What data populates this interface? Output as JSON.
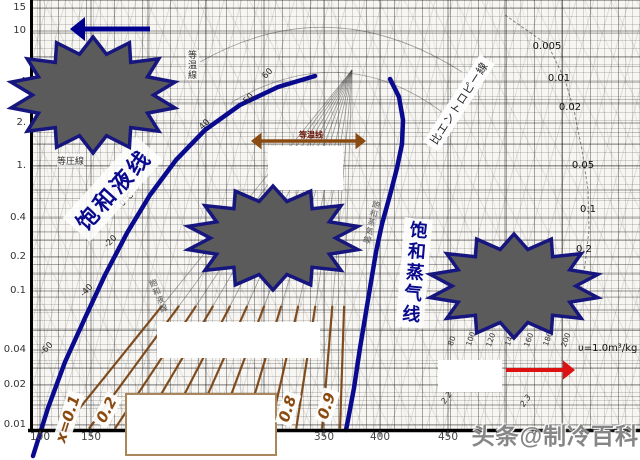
{
  "figure": {
    "width": 640,
    "height": 460
  },
  "watermark": {
    "text": "头条@制冷百科"
  },
  "annotations": {
    "sat_liquid_label": "饱和液线",
    "sat_vapor_label": "饱和蒸气线",
    "isotherm_arrow_label": "等温线",
    "isobar_print_label": "等圧線",
    "isotherm_print_label": "等温線",
    "entropy_print_label": "比エントロピー線",
    "vapor_print_label": "飽和蒸気線",
    "liquid_print_label": "飽和液線",
    "volume_note": "υ=1.0m³/kg"
  },
  "chart_data": {
    "type": "line",
    "title": "",
    "x_axis": {
      "label": "",
      "ticks": [
        {
          "label": "100",
          "x": 40
        },
        {
          "label": "150",
          "x": 91
        },
        {
          "label": "350",
          "x": 324
        },
        {
          "label": "400",
          "x": 380
        },
        {
          "label": "450",
          "x": 448
        },
        {
          "label": "500",
          "x": 505
        }
      ]
    },
    "y_axis": {
      "label": "",
      "scale": "log",
      "ticks": [
        {
          "label": "15",
          "y": 8
        },
        {
          "label": "10",
          "y": 31
        },
        {
          "label": "4",
          "y": 82
        },
        {
          "label": "2.",
          "y": 123
        },
        {
          "label": "1.",
          "y": 166
        },
        {
          "label": "0.4",
          "y": 218
        },
        {
          "label": "0.2",
          "y": 257
        },
        {
          "label": "0.1",
          "y": 291
        },
        {
          "label": "0.04",
          "y": 350
        },
        {
          "label": "0.02",
          "y": 385
        },
        {
          "label": "0.01",
          "y": 425
        }
      ]
    },
    "saturation_temp_labels": [
      {
        "label": "60",
        "x": 268,
        "y": 74
      },
      {
        "label": "50",
        "x": 249,
        "y": 99
      },
      {
        "label": "40",
        "x": 205,
        "y": 125
      },
      {
        "label": "20",
        "x": 140,
        "y": 166
      },
      {
        "label": "0°C",
        "x": 127,
        "y": 200
      },
      {
        "label": "-20",
        "x": 111,
        "y": 242
      },
      {
        "label": "-40",
        "x": 87,
        "y": 291
      },
      {
        "label": "-60",
        "x": 47,
        "y": 349
      }
    ],
    "specific_volume_labels": [
      {
        "label": "0.005",
        "x": 547,
        "y": 47
      },
      {
        "label": "0.01",
        "x": 559,
        "y": 79
      },
      {
        "label": "0.02",
        "x": 570,
        "y": 108
      },
      {
        "label": "0.05",
        "x": 583,
        "y": 166
      },
      {
        "label": "0.1",
        "x": 588,
        "y": 210
      },
      {
        "label": "0.2",
        "x": 584,
        "y": 250
      }
    ],
    "superheat_temp_labels": [
      {
        "label": "80",
        "x": 452,
        "y": 341
      },
      {
        "label": "100",
        "x": 471,
        "y": 339
      },
      {
        "label": "120",
        "x": 491,
        "y": 340
      },
      {
        "label": "140",
        "x": 510,
        "y": 339
      },
      {
        "label": "160",
        "x": 529,
        "y": 340
      },
      {
        "label": "180",
        "x": 548,
        "y": 339
      },
      {
        "label": "200",
        "x": 566,
        "y": 340
      }
    ],
    "entropy_tick_labels": [
      {
        "label": "2.2",
        "x": 447,
        "y": 398
      },
      {
        "label": "2.3",
        "x": 526,
        "y": 401
      }
    ],
    "quality_labels": [
      {
        "label": "x=0.1",
        "x": 68,
        "y": 419,
        "rot": -72
      },
      {
        "label": "0.2",
        "x": 107,
        "y": 410,
        "rot": -62
      },
      {
        "label": "0.8",
        "x": 288,
        "y": 409,
        "rot": -72
      },
      {
        "label": "0.9",
        "x": 327,
        "y": 406,
        "rot": -72
      }
    ],
    "series": [
      {
        "name": "saturated-liquid-line",
        "color": "#0a0a8f",
        "width": 4.5,
        "points": [
          [
            33,
            456
          ],
          [
            48,
            408
          ],
          [
            65,
            362
          ],
          [
            85,
            318
          ],
          [
            105,
            275
          ],
          [
            127,
            233
          ],
          [
            150,
            195
          ],
          [
            176,
            160
          ],
          [
            205,
            130
          ],
          [
            240,
            105
          ],
          [
            278,
            87
          ],
          [
            315,
            76
          ]
        ]
      },
      {
        "name": "saturated-vapor-line",
        "color": "#0a0a8f",
        "width": 4.5,
        "points": [
          [
            390,
            79
          ],
          [
            399,
            97
          ],
          [
            403,
            120
          ],
          [
            402,
            144
          ],
          [
            397,
            168
          ],
          [
            390,
            195
          ],
          [
            382,
            224
          ],
          [
            376,
            252
          ],
          [
            371,
            282
          ],
          [
            366,
            312
          ],
          [
            360,
            348
          ],
          [
            354,
            388
          ],
          [
            348,
            420
          ],
          [
            346,
            430
          ]
        ]
      }
    ]
  },
  "decorations": {
    "censor_stars": [
      {
        "cx": 93,
        "cy": 95,
        "rx": 84,
        "ry": 58
      },
      {
        "cx": 273,
        "cy": 238,
        "rx": 87,
        "ry": 52
      },
      {
        "cx": 514,
        "cy": 286,
        "rx": 86,
        "ry": 52
      }
    ],
    "star_fill": "#5b5b5b",
    "star_stroke": "#16167e",
    "white_boxes": [
      {
        "x": 268,
        "y": 146,
        "w": 75,
        "h": 44,
        "border": ""
      },
      {
        "x": 157,
        "y": 322,
        "w": 163,
        "h": 36,
        "border": ""
      },
      {
        "x": 125,
        "y": 393,
        "w": 148,
        "h": 59,
        "border": "#a9875a"
      },
      {
        "x": 438,
        "y": 360,
        "w": 64,
        "h": 32,
        "border": ""
      }
    ],
    "arrows": [
      {
        "name": "cycle-direction-arrow",
        "x1": 150,
        "y1": 29,
        "x2": 70,
        "y2": 29,
        "color": "#00008f",
        "width": 5,
        "double": false
      },
      {
        "name": "isotherm-span-arrow",
        "x1": 251,
        "y1": 141,
        "x2": 366,
        "y2": 141,
        "color": "#8a4b12",
        "width": 3.5,
        "double": true
      },
      {
        "name": "superheat-direction-arrow",
        "x1": 506,
        "y1": 370,
        "x2": 575,
        "y2": 370,
        "color": "#dd1111",
        "width": 4,
        "double": false
      }
    ],
    "vgrid": [
      40,
      91,
      148,
      206,
      264,
      324,
      380,
      448,
      505,
      562
    ],
    "hgrid": [
      8,
      31,
      57,
      82,
      103,
      123,
      144,
      166,
      190,
      218,
      240,
      257,
      274,
      291,
      310,
      330,
      350,
      368,
      385,
      405,
      425
    ],
    "fan_bottom_x": [
      62,
      88,
      114,
      140,
      166,
      192,
      218,
      244,
      270,
      296,
      322,
      340
    ],
    "fan_apex": [
      352,
      70
    ],
    "hatch_color": "#7a4312",
    "volume_guide": [
      [
        505,
        15
      ],
      [
        548,
        45
      ],
      [
        565,
        80
      ],
      [
        574,
        110
      ],
      [
        582,
        150
      ],
      [
        588,
        190
      ],
      [
        589,
        230
      ],
      [
        585,
        265
      ],
      [
        580,
        300
      ]
    ]
  }
}
